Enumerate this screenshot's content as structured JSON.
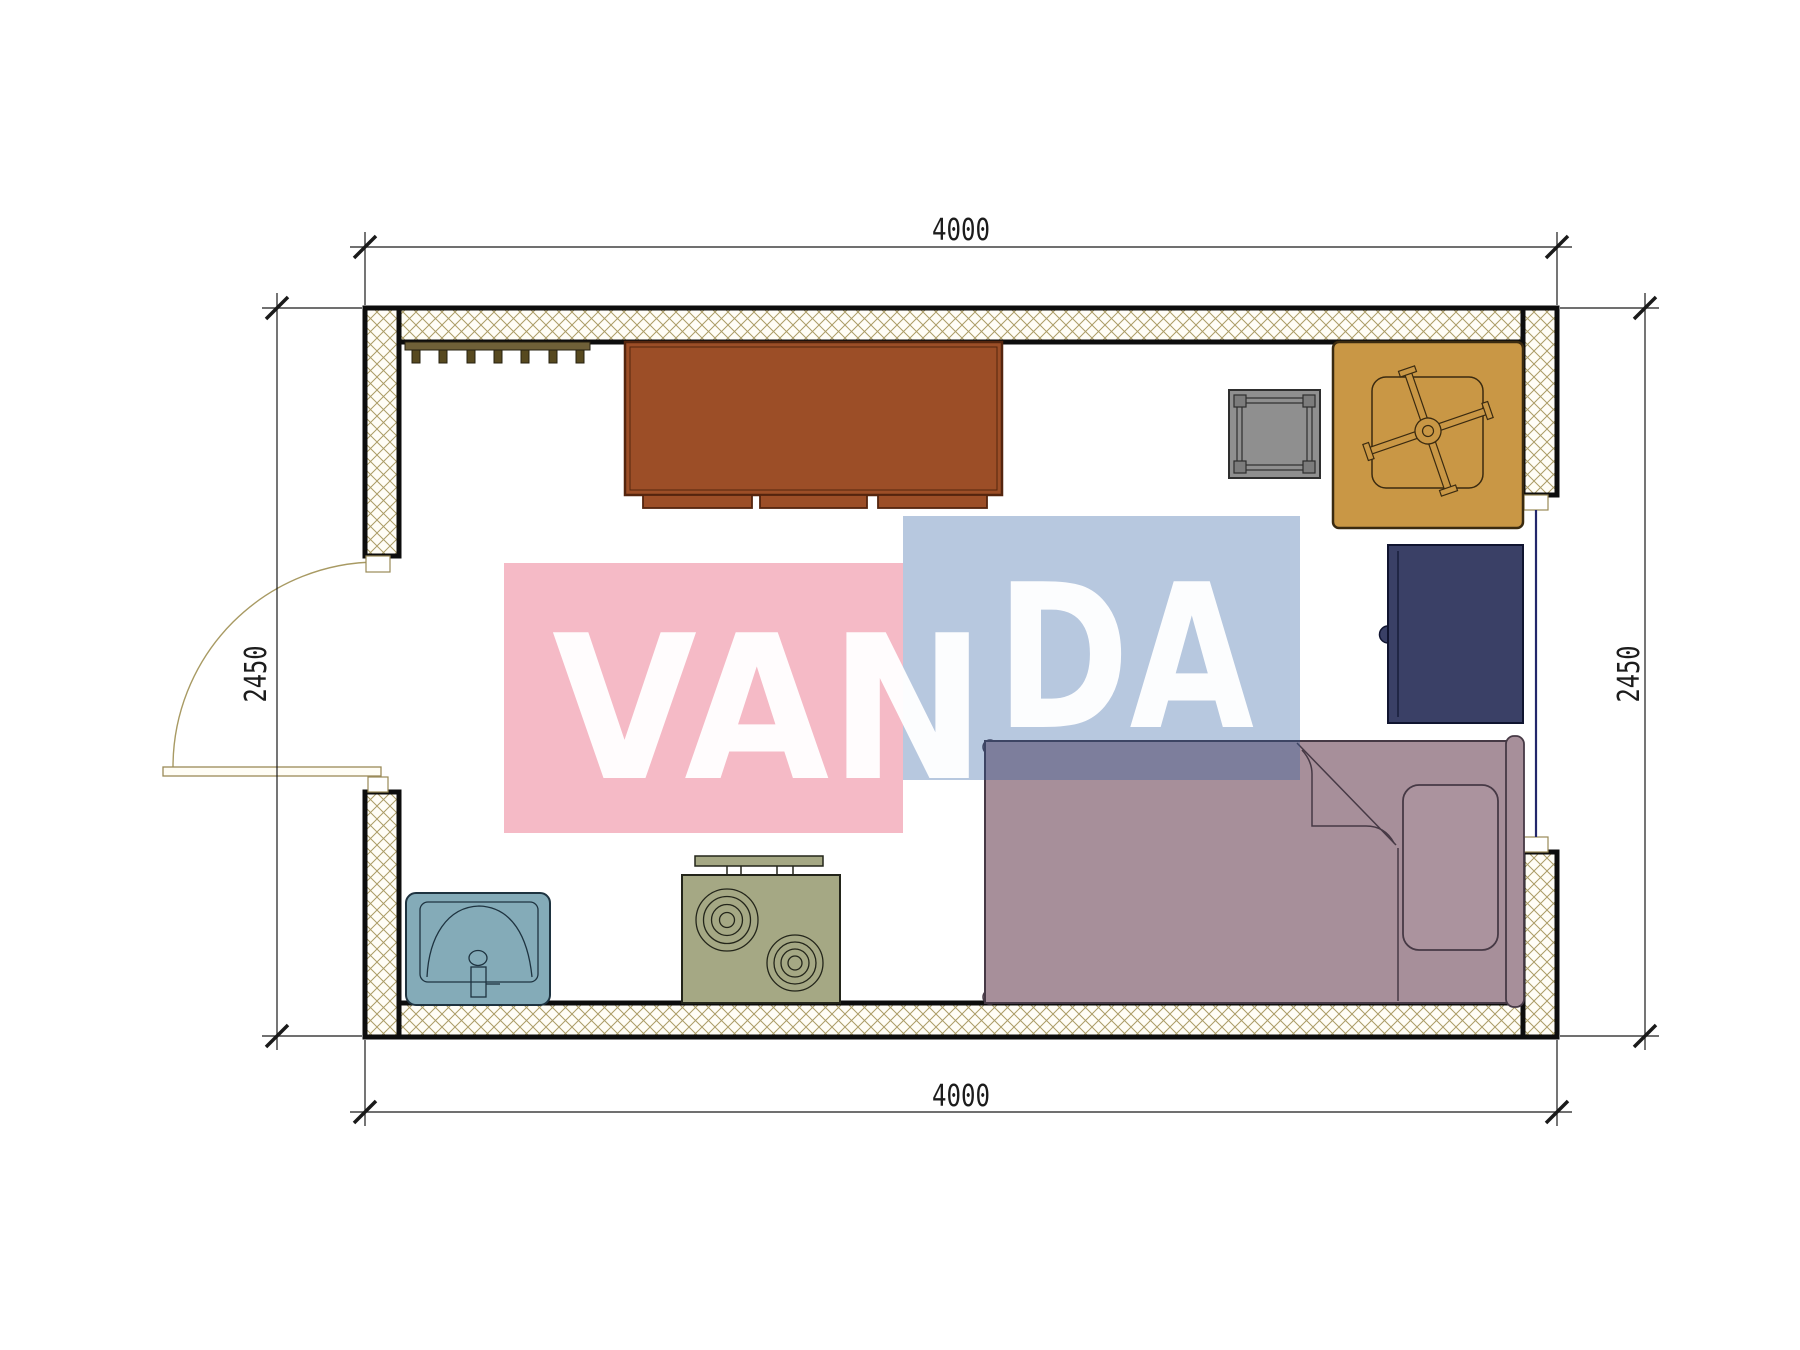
{
  "page": {
    "title": "floor-plan",
    "background": "#ffffff"
  },
  "dimensions": {
    "top": "4000",
    "bottom": "4000",
    "left": "2450",
    "right": "2450"
  },
  "watermark": {
    "left_text": "VAN",
    "right_text": "DA",
    "pink_color": "rgba(231,91,120,0.42)",
    "blue_color": "rgba(45,95,160,0.34)",
    "text_color": "rgba(255,255,255,0.96)"
  },
  "plan": {
    "hatch_line_color": "#ab9c66",
    "wall_edge_color": "#0d0d0d",
    "window_glass_color": "#23276b",
    "furniture": {
      "coat_rack": {
        "label": "coat rack",
        "color": "#6f6038"
      },
      "cabinet": {
        "label": "cabinet",
        "color": "#9c4e27"
      },
      "stool": {
        "label": "stool",
        "color": "#8f8f8f"
      },
      "table_with_chair": {
        "label": "table with swivel chair",
        "color": "#c99745"
      },
      "fridge": {
        "label": "fridge",
        "color": "#3a4066"
      },
      "bed": {
        "label": "single bed",
        "color": "#a78f9a"
      },
      "sink": {
        "label": "sink",
        "color": "#84abb8"
      },
      "stove": {
        "label": "stove",
        "color": "#a5a884"
      }
    }
  }
}
